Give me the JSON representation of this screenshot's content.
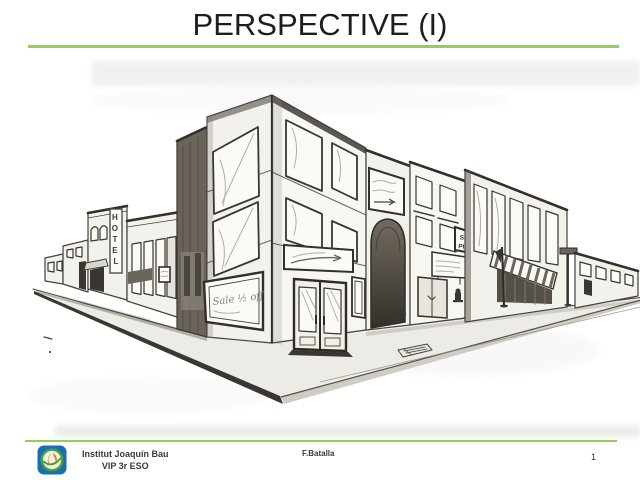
{
  "slide": {
    "title": "PERSPECTIVE (I)",
    "accent_color": "#92d050"
  },
  "drawing": {
    "alt": "Pencil sketch of a street corner drawn in two-point perspective with shops and buildings",
    "hotel_letters": [
      "H",
      "O",
      "T",
      "E",
      "L"
    ],
    "sale_sign": "Sale ½ off",
    "pits_sign_line1": "SEN",
    "pits_sign_line2": "PITS"
  },
  "footer": {
    "institution": "Institut Joaquín Bau",
    "course": "VIP 3r ESO",
    "author": "F.Batalla",
    "page_number": "1"
  }
}
